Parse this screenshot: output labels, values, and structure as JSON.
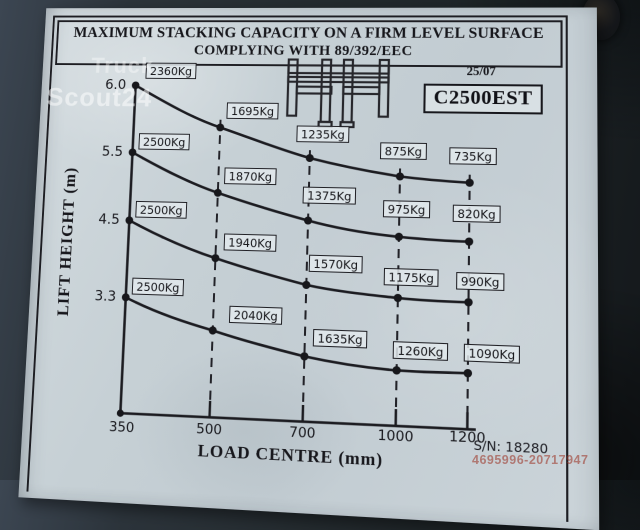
{
  "plate": {
    "title_line1": "MAXIMUM STACKING CAPACITY ON A FIRM LEVEL SURFACE",
    "title_line2": "COMPLYING WITH 89/392/EEC",
    "date_code": "25/07",
    "model": "C2500EST",
    "serial": "S/N: 18280"
  },
  "watermark": {
    "line1": "Truck",
    "line2": "Scout24",
    "photo_id": "4695996-20717947"
  },
  "chart_data": {
    "type": "line",
    "title": "MAXIMUM STACKING CAPACITY ON A FIRM LEVEL SURFACE COMPLYING WITH 89/392/EEC",
    "xlabel": "LOAD CENTRE (mm)",
    "ylabel": "LIFT HEIGHT (m)",
    "x": [
      350,
      500,
      700,
      1000,
      1200
    ],
    "x_ticks": [
      "350",
      "500",
      "700",
      "1000",
      "1200"
    ],
    "y_ticks": [
      "6.0",
      "5.5",
      "4.5",
      "3.3"
    ],
    "grid": "dashed vertical lines at each load centre",
    "legend": "none; each curve labelled by lift height at left axis",
    "units": "Kg",
    "series": [
      {
        "name": "lift height 6.0 m",
        "lift_height_m": 6.0,
        "values": [
          2360,
          1695,
          1235,
          875,
          735
        ],
        "point_labels": [
          "2360Kg",
          "1695Kg",
          "1235Kg",
          "875Kg",
          "735Kg"
        ]
      },
      {
        "name": "lift height 5.5 m",
        "lift_height_m": 5.5,
        "values": [
          2500,
          1870,
          1375,
          975,
          820
        ],
        "point_labels": [
          "2500Kg",
          "1870Kg",
          "1375Kg",
          "975Kg",
          "820Kg"
        ]
      },
      {
        "name": "lift height 4.5 m",
        "lift_height_m": 4.5,
        "values": [
          2500,
          1940,
          1570,
          1175,
          990
        ],
        "point_labels": [
          "2500Kg",
          "1940Kg",
          "1570Kg",
          "1175Kg",
          "990Kg"
        ]
      },
      {
        "name": "lift height 3.3 m",
        "lift_height_m": 3.3,
        "values": [
          2500,
          2040,
          1635,
          1260,
          1090
        ],
        "point_labels": [
          "2500Kg",
          "2040Kg",
          "1635Kg",
          "1260Kg",
          "1090Kg"
        ]
      }
    ]
  }
}
